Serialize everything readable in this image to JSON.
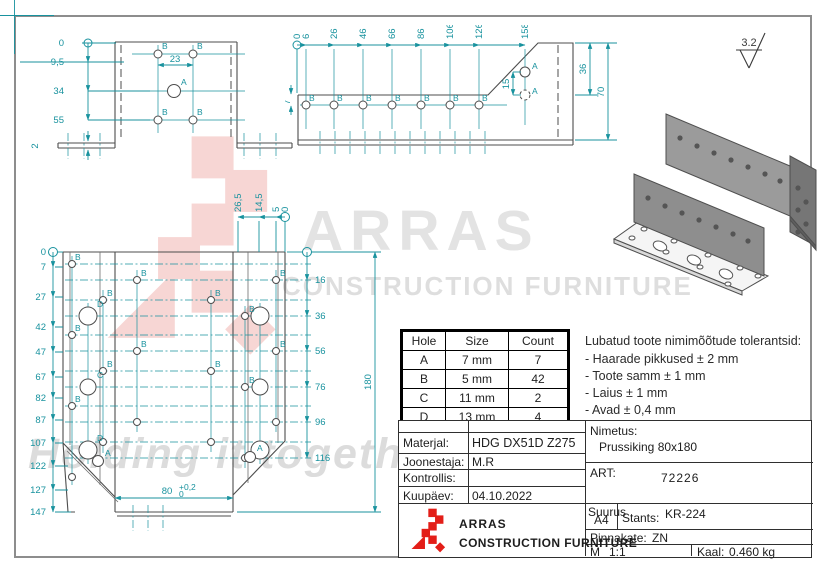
{
  "colors": {
    "dim_teal": "#18929e",
    "line_gray": "#4d4d4d",
    "brand_red": "#e31e18"
  },
  "surface_finish": "3.2",
  "letters": {
    "A": "A",
    "B": "B",
    "C": "C",
    "D": "D"
  },
  "watermark": {
    "brand": "ARRAS",
    "subtitle": "CONSTRUCTION FURNITURE",
    "tagline": "Holding it together"
  },
  "views": {
    "front": {
      "left_dims": [
        "0",
        "9,5",
        "34",
        "55"
      ],
      "thickness_dim": "2",
      "span_dim": "23"
    },
    "side": {
      "stations": [
        "0",
        "6",
        "26",
        "46",
        "66",
        "86",
        "106",
        "126",
        "158"
      ],
      "flange_dim": "7",
      "a_gap_dim": "15",
      "height_top_dim": "36",
      "height_total_dim": "70"
    },
    "plan": {
      "left_dims": [
        "0",
        "7",
        "27",
        "42",
        "47",
        "67",
        "82",
        "87",
        "107",
        "122",
        "127",
        "147"
      ],
      "top_dims": [
        "26,5",
        "14,5",
        "5",
        "0"
      ],
      "right_dims": [
        "16",
        "36",
        "56",
        "76",
        "96",
        "116"
      ],
      "total_dim": "180",
      "width_dim": "80",
      "width_tol_up": "+0,2",
      "width_tol_dn": "0"
    }
  },
  "hole_table": {
    "headers": [
      "Hole",
      "Size",
      "Count"
    ],
    "rows": [
      [
        "A",
        "7 mm",
        "7"
      ],
      [
        "B",
        "5 mm",
        "42"
      ],
      [
        "C",
        "11 mm",
        "2"
      ],
      [
        "D",
        "13 mm",
        "4"
      ]
    ]
  },
  "tolerances": {
    "title": "Lubatud toote nimimõõtude tolerantsid:",
    "items": [
      "- Haarade pikkused ± 2 mm",
      "- Toote samm ± 1 mm",
      "- Laius ± 1 mm",
      "- Avad ± 0,4 mm"
    ]
  },
  "title_block": {
    "material_label": "Materjal:",
    "material": "HDG DX51D Z275",
    "drafter_label": "Joonestaja:",
    "drafter": "M.R",
    "checker_label": "Kontrollis:",
    "checker": "",
    "date_label": "Kuupäev:",
    "date": "04.10.2022",
    "name_label": "Nimetus:",
    "name": "Prussiking 80x180",
    "art_label": "ART:",
    "art": "72226",
    "size_label": "Suurus",
    "size": "A4",
    "die_label": "Stants:",
    "die": "KR-224",
    "coating_label": "Pinnakate:",
    "coating": "ZN",
    "scale_label": "M",
    "scale": "1:1",
    "weight_label": "Kaal:",
    "weight": "0.460 kg",
    "brand": "ARRAS",
    "brand_sub": "CONSTRUCTION FURNITURE"
  }
}
